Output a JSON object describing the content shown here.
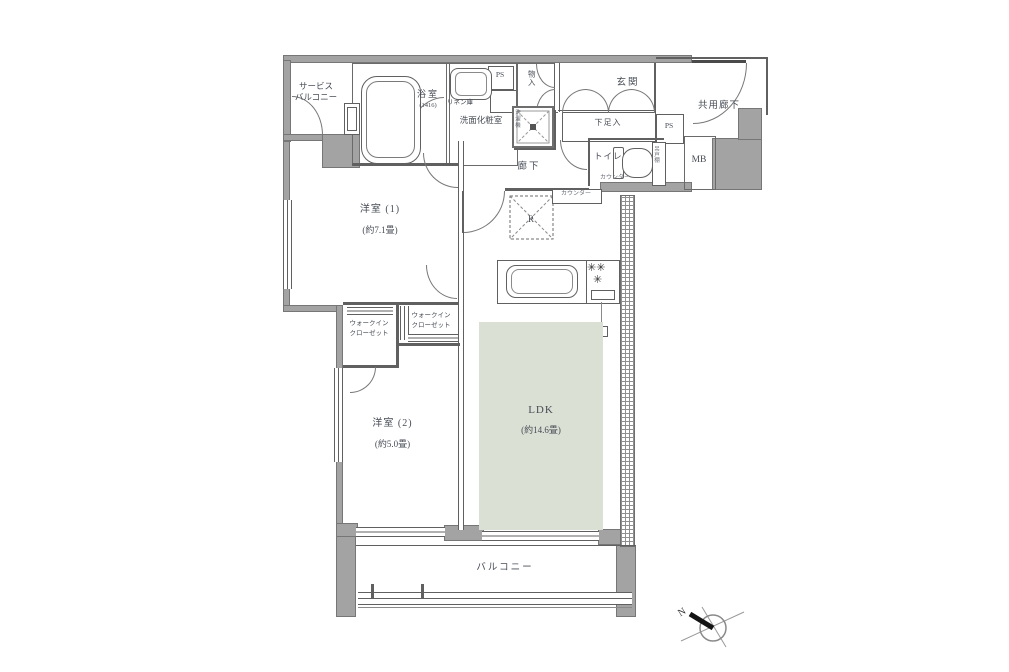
{
  "labels": {
    "service_balcony_1": "サービス",
    "service_balcony_2": "バルコニー",
    "bath": "浴室",
    "bath_size": "(1416)",
    "linen": "リネン庫",
    "powder_room": "洗面化粧室",
    "ps_top": "PS",
    "storage": "物入",
    "washer": "洗濯機",
    "entrance": "玄関",
    "common_corridor": "共用廊下",
    "shoe_box": "下足入",
    "ps_right": "PS",
    "meter_box": "MB",
    "toilet": "トイレ",
    "counter_toilet": "カウンター",
    "shelf": "吊戸棚",
    "corridor": "廊下",
    "fridge": "R",
    "counter_kitchen": "カウンター",
    "bedroom1": "洋室 (1)",
    "bedroom1_size": "(約7.1畳)",
    "wic_left_1": "ウォークイン",
    "wic_left_2": "クローゼット",
    "wic_right_1": "ウォークイン",
    "wic_right_2": "クローゼット",
    "bedroom2": "洋室 (2)",
    "bedroom2_size": "(約5.0畳)",
    "ldk": "LDK",
    "ldk_size": "(約14.6畳)",
    "balcony": "バルコニー",
    "compass_n": "N"
  },
  "colors": {
    "wall": "#a3a3a3",
    "line": "#606060",
    "text": "#474c55",
    "ldk_floor": "#dbe0d5"
  }
}
